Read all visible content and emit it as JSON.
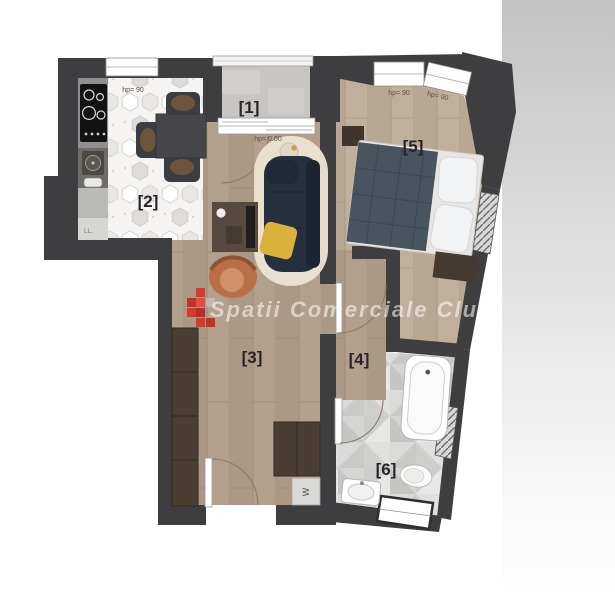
{
  "watermark": {
    "text": "Spatii Comerciale Cluj",
    "logo_color": "#d6392e"
  },
  "rooms": {
    "balcony": {
      "label": "[1]"
    },
    "kitchen": {
      "label": "[2]"
    },
    "living": {
      "label": "[3]"
    },
    "hallway": {
      "label": "[4]"
    },
    "bedroom": {
      "label": "[5]"
    },
    "bathroom": {
      "label": "[6]"
    }
  },
  "annotations": {
    "kitchen_window_height": "hp= 90",
    "balcony_door_height": "hp= 0.00",
    "bedroom_window1_height": "hp= 90",
    "bedroom_window2_height": "hp= 90",
    "kitchen_appliance": "LL.",
    "washing_machine": "W"
  },
  "colors": {
    "wall": "#3e3e41",
    "wood_floor": "#b2a08c",
    "bedroom_floor": "#c0af9a",
    "bathroom_tile": "#dddddb",
    "concrete": "#c7c6c3",
    "sofa": "#25303f",
    "accent_pillow": "#d9b13b",
    "furniture_brown": "#4a3e33"
  }
}
